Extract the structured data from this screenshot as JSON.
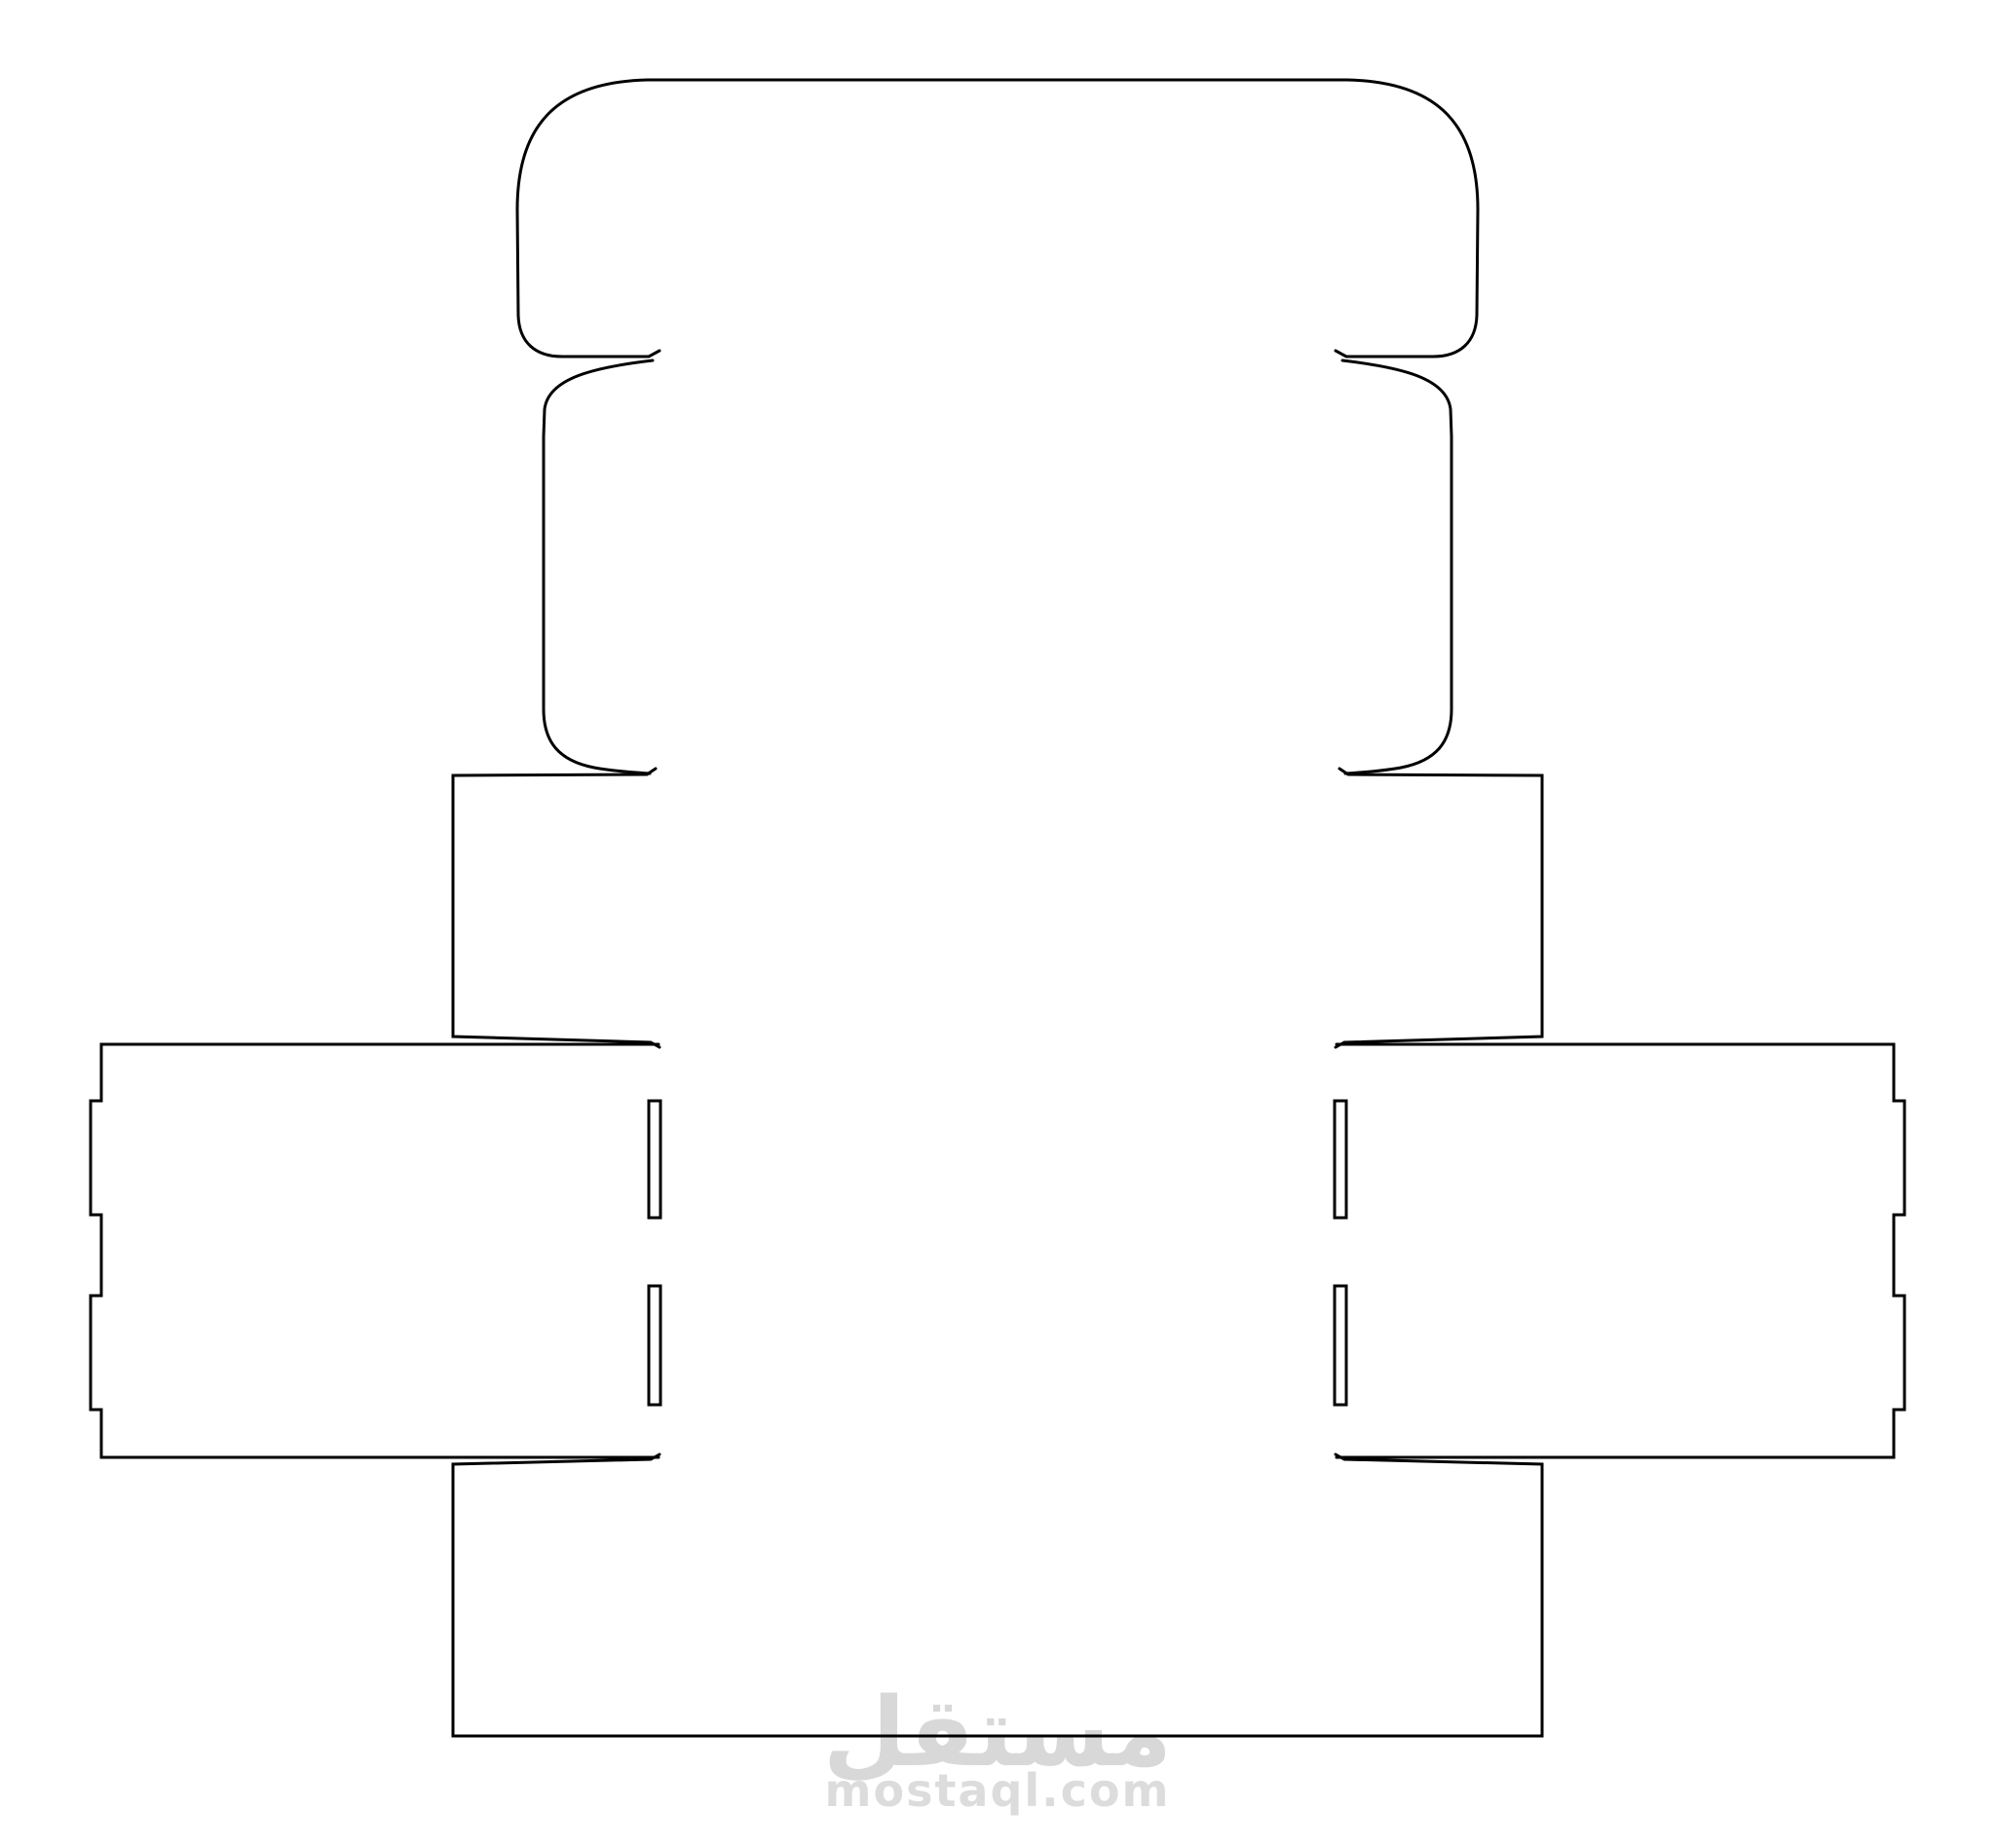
{
  "document": {
    "kind": "packaging-dieline-template",
    "background_color": "#ffffff",
    "cut_line_color": "#000000"
  },
  "watermark": {
    "logo_text": "مستقل",
    "site_text": "mostaql.com",
    "logo_color": "#d8d8d8",
    "site_color": "#dcdcdc"
  }
}
